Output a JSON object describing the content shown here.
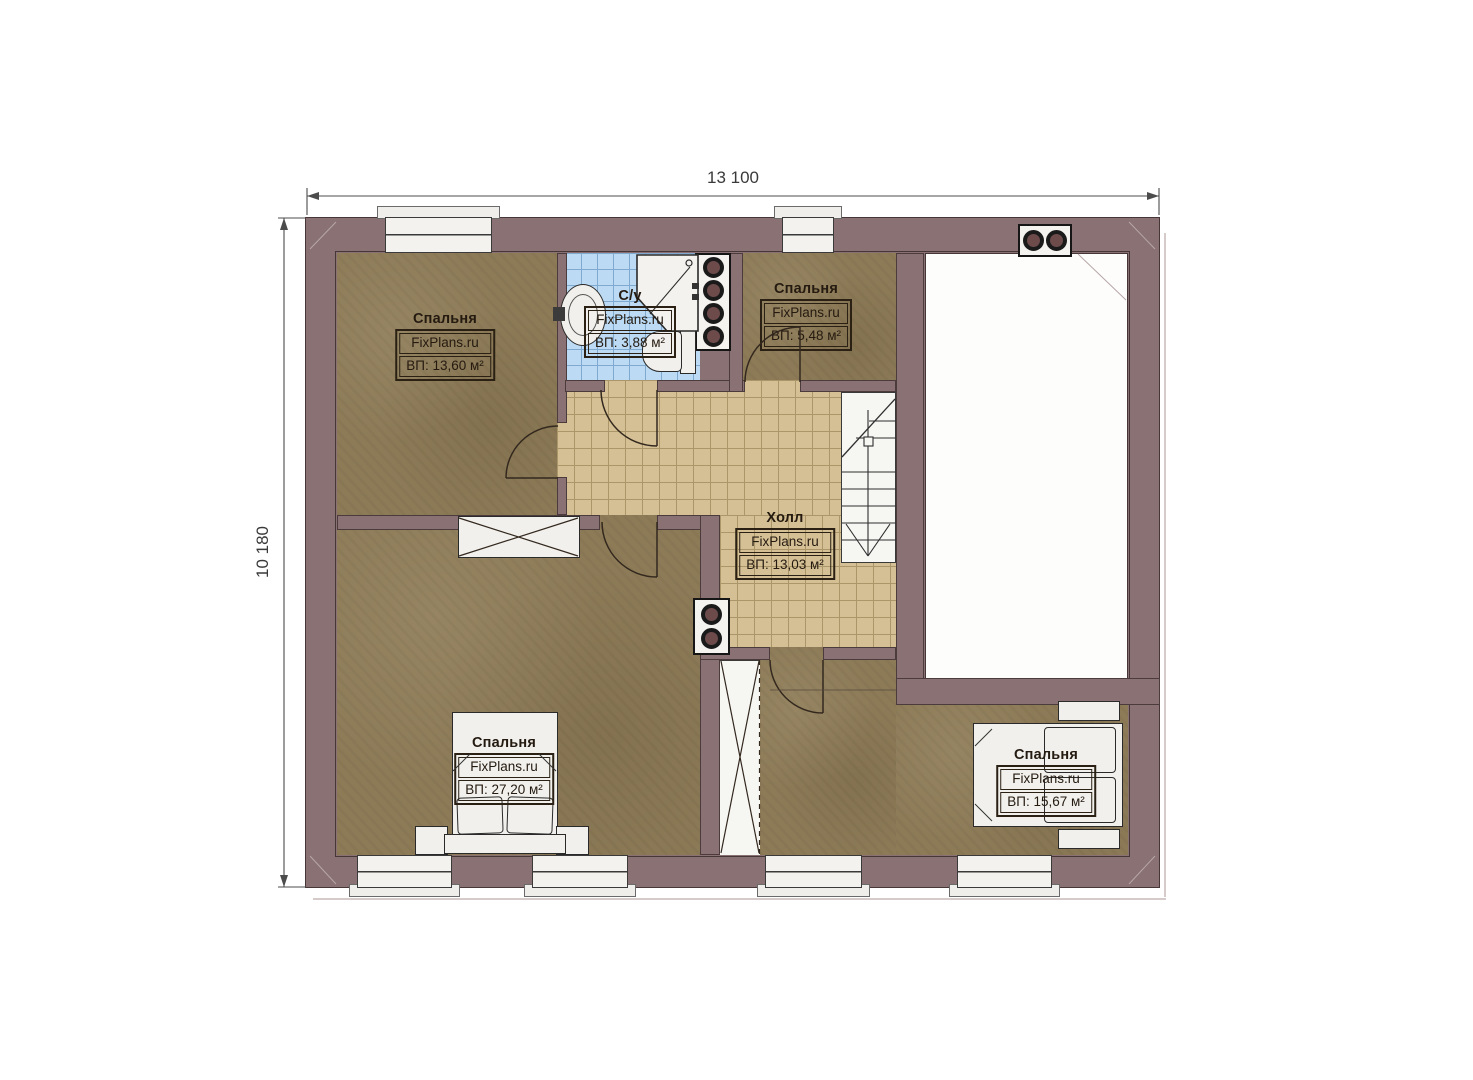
{
  "plan": {
    "watermark": "FixPlans.ru",
    "dimensions": {
      "width_label": "13 100",
      "height_label": "10 180"
    },
    "rooms": [
      {
        "key": "bedroom-top-left",
        "name": "Спальня",
        "area": "ВП: 13,60 м²"
      },
      {
        "key": "bathroom",
        "name": "С/у",
        "area": "ВП: 3,88 м²"
      },
      {
        "key": "bedroom-top-middle",
        "name": "Спальня",
        "area": "ВП: 5,48 м²"
      },
      {
        "key": "hall",
        "name": "Холл",
        "area": "ВП: 13,03 м²"
      },
      {
        "key": "bedroom-bottom-left",
        "name": "Спальня",
        "area": "ВП: 27,20 м²"
      },
      {
        "key": "bedroom-bottom-right",
        "name": "Спальня",
        "area": "ВП: 15,67 м²"
      }
    ],
    "colors": {
      "wall": "#8a7173",
      "floor_wood": "#8d7b58",
      "tile_hall": "#d5c095",
      "tile_bath": "#bcdaf3",
      "fixture_white": "#f1f0ec"
    }
  }
}
